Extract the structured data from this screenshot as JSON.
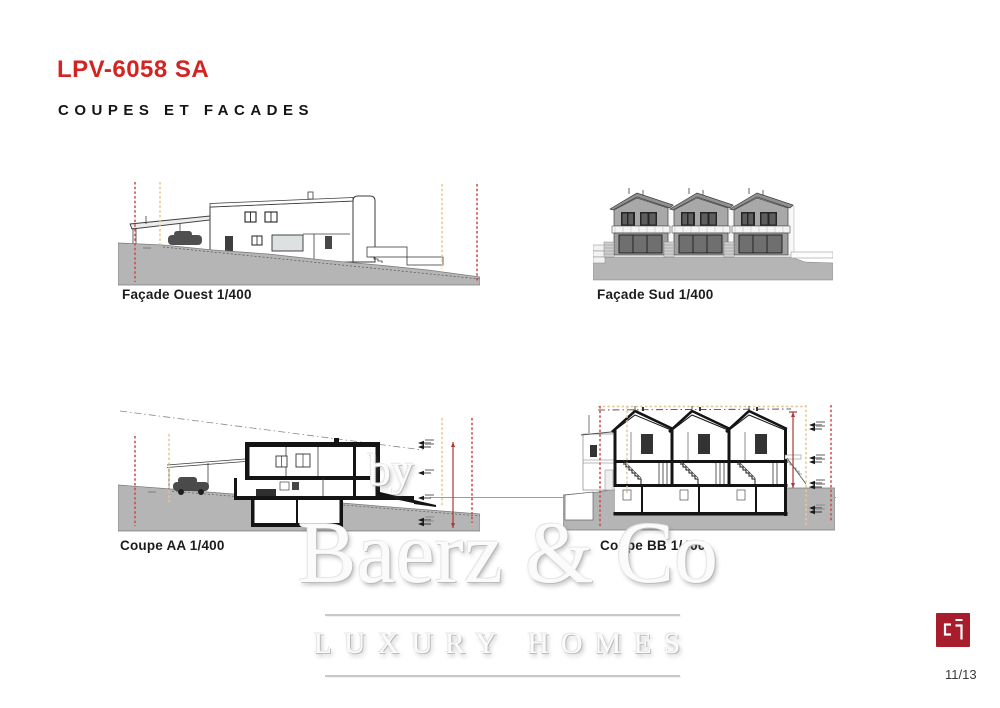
{
  "header": {
    "title": "LPV-6058 SA",
    "subtitle": "COUPES ET FACADES"
  },
  "drawings": [
    {
      "id": "facade-ouest",
      "label": "Façade Ouest  1/400"
    },
    {
      "id": "facade-sud",
      "label": "Façade Sud  1/400"
    },
    {
      "id": "coupe-aa",
      "label": "Coupe  AA 1/400"
    },
    {
      "id": "coupe-bb",
      "label": "Coupe  BB 1/400"
    }
  ],
  "watermark": {
    "prefix": "by",
    "name": "Baerz & Co",
    "tagline": "LUXURY HOMES"
  },
  "footer": {
    "page_number": "11/13",
    "logo": "cp-logo"
  },
  "colors": {
    "accent_red": "#d42422",
    "logo_red": "#a81d2c",
    "terrain_gray": "#b5b5b5",
    "boundary_line_red": "#cb4848",
    "boundary_line_tan": "#e6c693",
    "dimension_red": "#b03535",
    "cut_wall_black": "#141414"
  }
}
